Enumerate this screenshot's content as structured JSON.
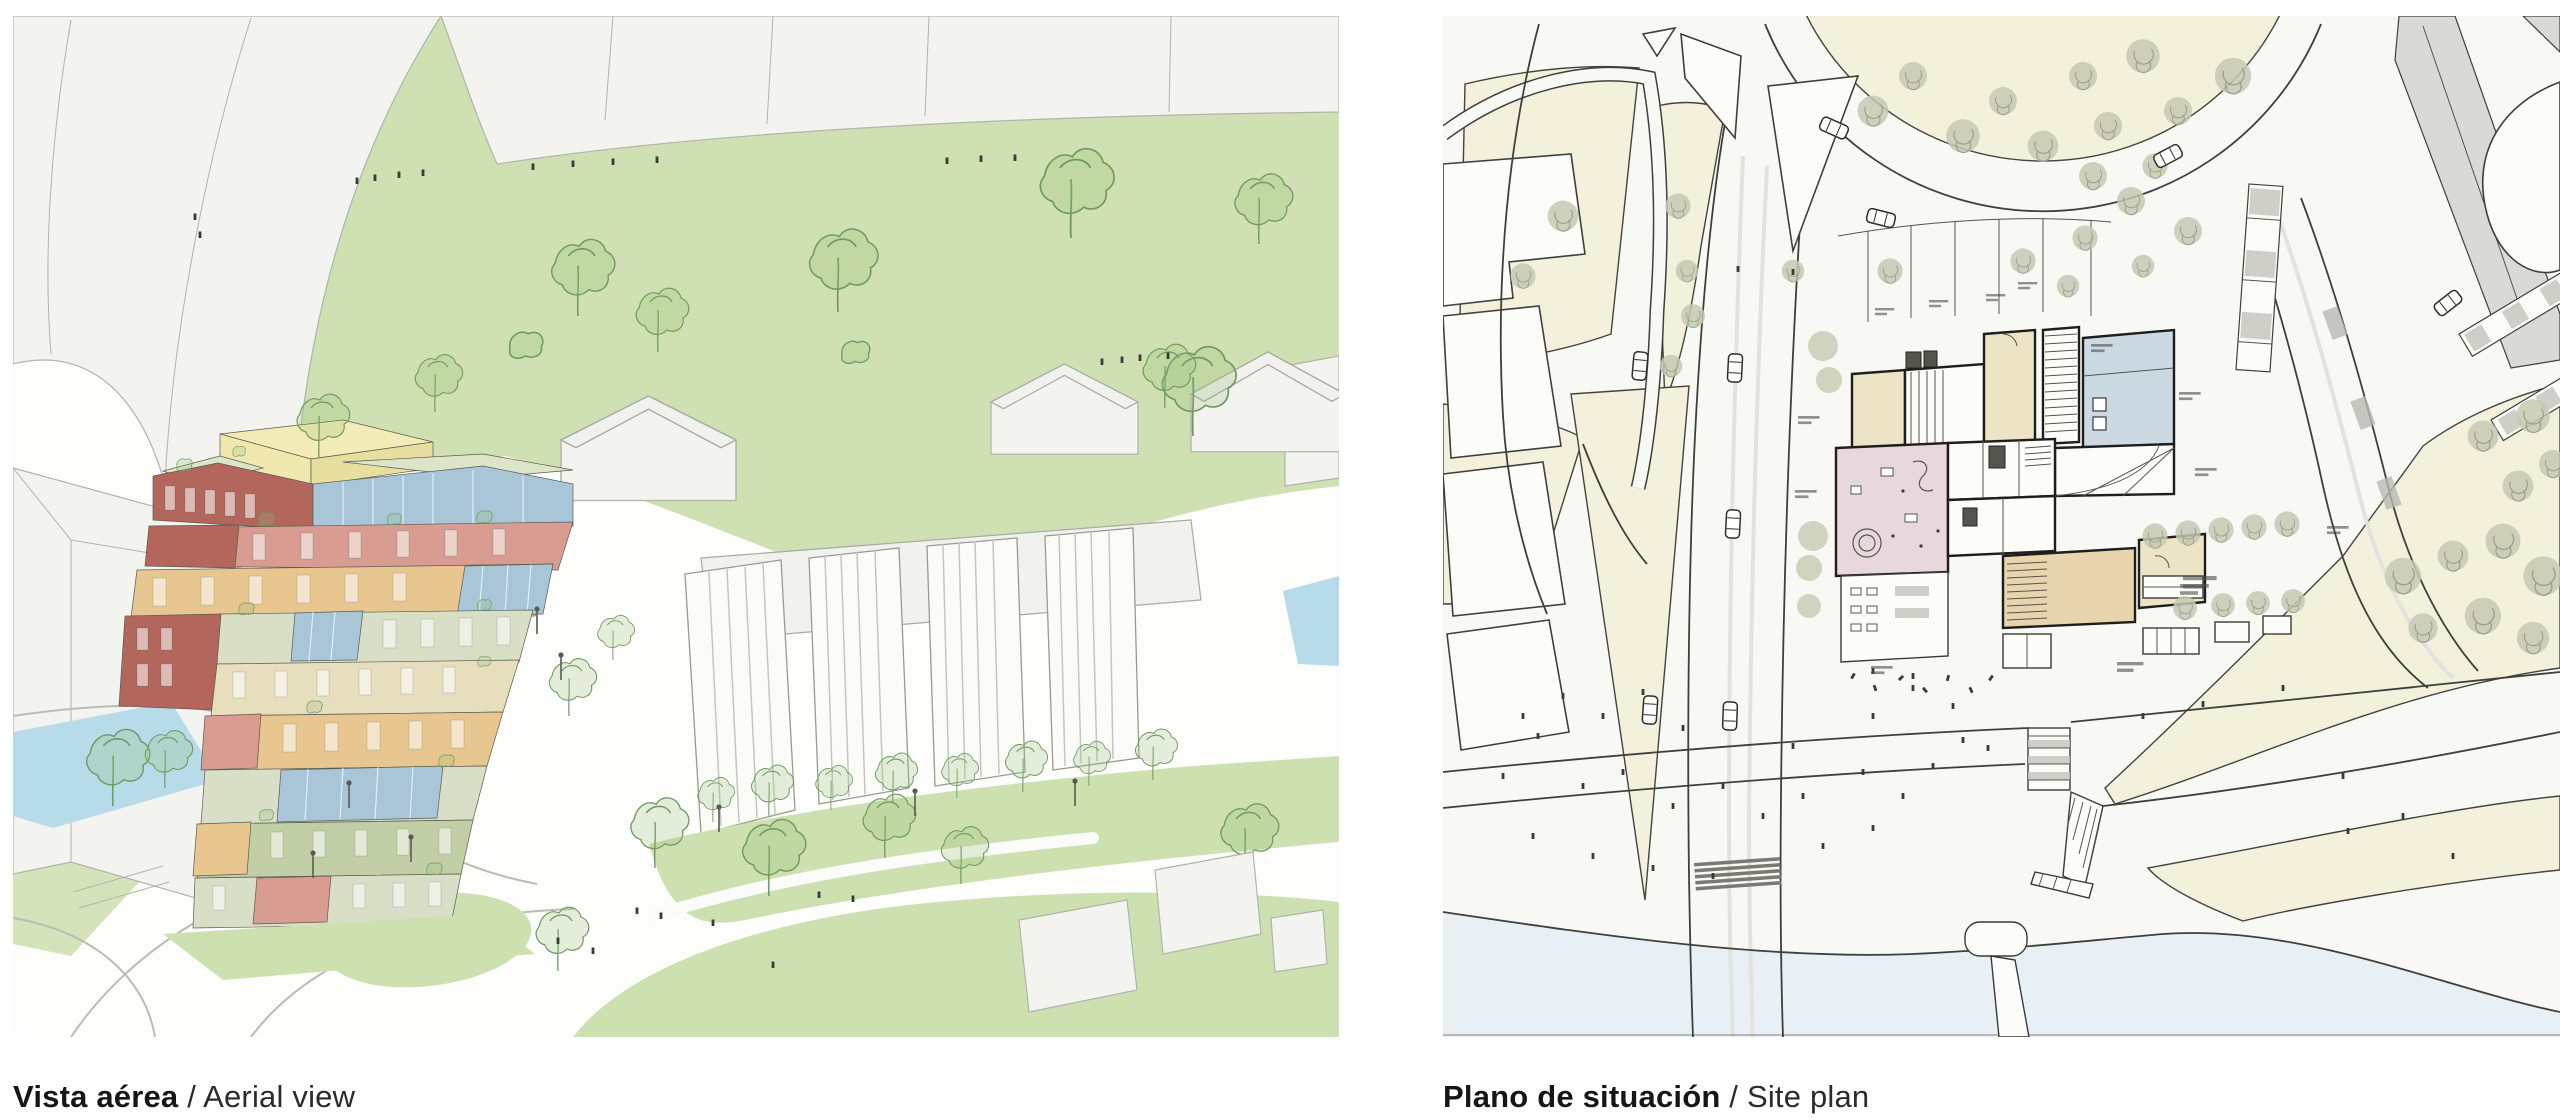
{
  "board": {
    "background": "#ffffff"
  },
  "figures": [
    {
      "id": "aerial-view",
      "caption_primary": "Vista aérea",
      "caption_separator": " / ",
      "caption_secondary": "Aerial view"
    },
    {
      "id": "site-plan",
      "caption_primary": "Plano de situación",
      "caption_separator": " / ",
      "caption_secondary": "Site plan"
    }
  ],
  "palette": {
    "canvas": "#fdfdfb",
    "context_building": "#f3f3f0",
    "park_green": "#cfe0b2",
    "lawn_green": "#cde0b0",
    "tree_stroke": "#6f9a62",
    "water_blue": "#b7dbe9",
    "tower_yellow": "#f0e8ae",
    "tower_red": "#b2665c",
    "tower_salmon": "#d89c90",
    "tower_blue": "#a8c6d8",
    "tower_orange": "#e7c690",
    "tower_sage": "#d8dfc6",
    "tower_green": "#c2cfa6",
    "plan_canvas": "#f8f8f4",
    "plan_cream": "#f3f0dc",
    "plan_room_pink": "#e8d7dc",
    "plan_room_blue": "#cbdae2",
    "plan_room_beige": "#ede4c6",
    "plan_room_tan": "#e8d5ae",
    "plan_tree_fill": "#c6c9b2",
    "plan_wall": "#1e1e1c",
    "plan_water": "#e9f0f5",
    "plan_gray_building": "#d9d9d5"
  }
}
